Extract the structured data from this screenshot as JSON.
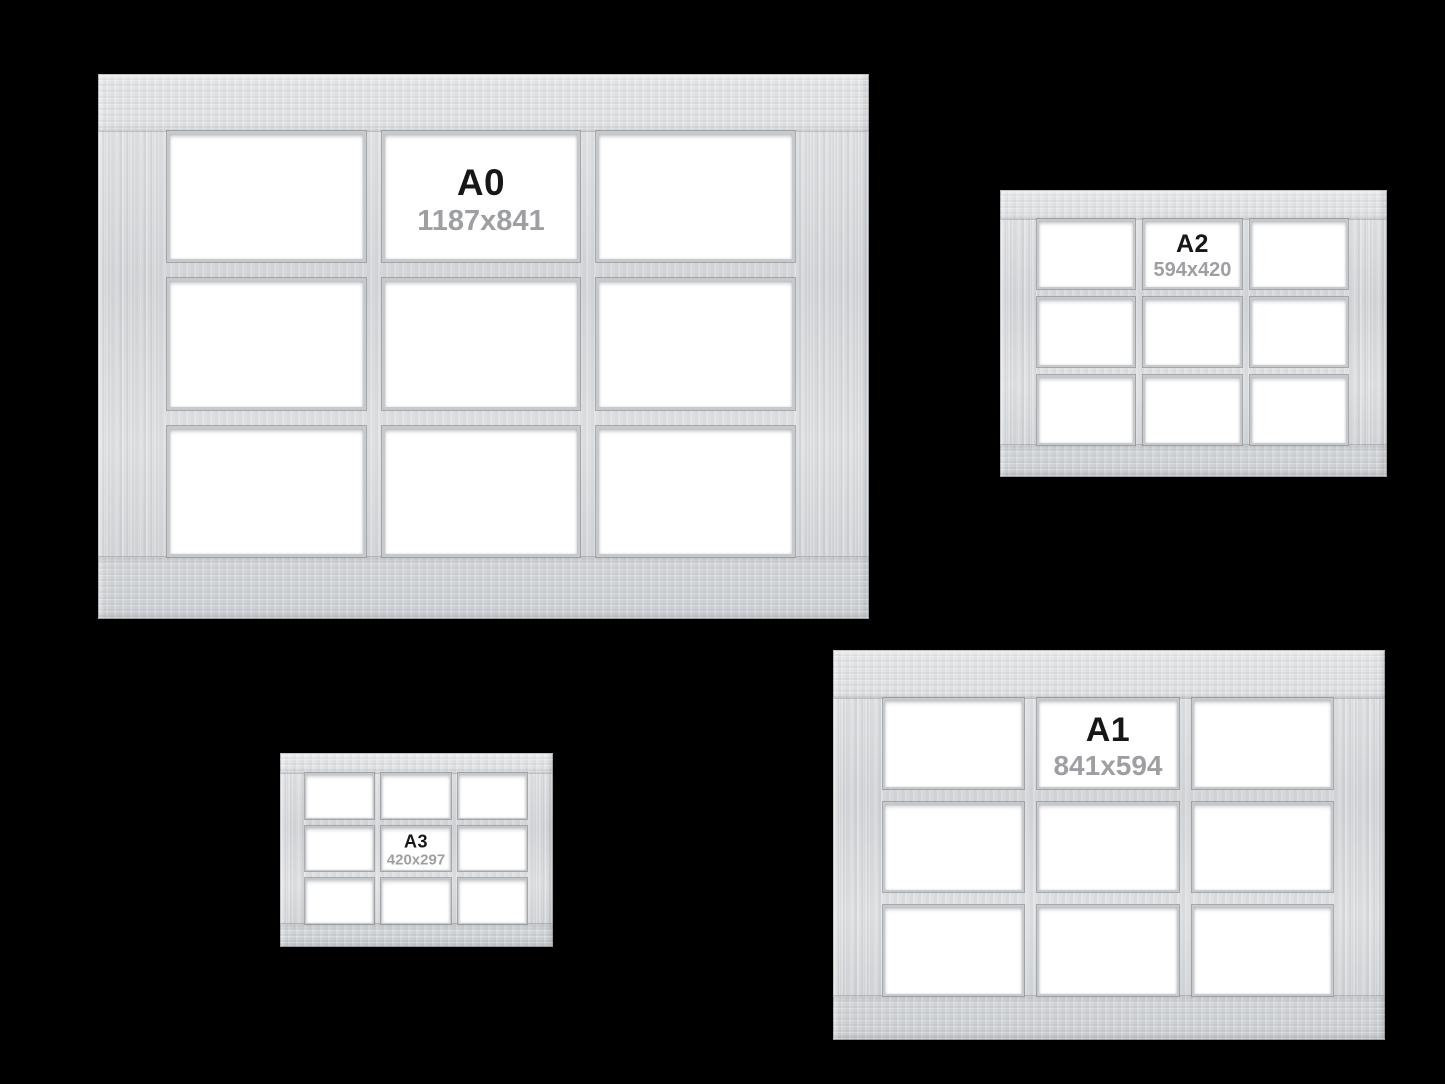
{
  "background_color": "#000000",
  "colors": {
    "frame_wood": "#d8dadc",
    "pane": "#ffffff",
    "size_label_text": "#171717",
    "dimension_text": "#9b9ea2"
  },
  "frames": {
    "a0": {
      "label": "A0",
      "dimensions": "1187x841"
    },
    "a2": {
      "label": "A2",
      "dimensions": "594x420"
    },
    "a1": {
      "label": "A1",
      "dimensions": "841x594"
    },
    "a3": {
      "label": "A3",
      "dimensions": "420x297"
    }
  }
}
